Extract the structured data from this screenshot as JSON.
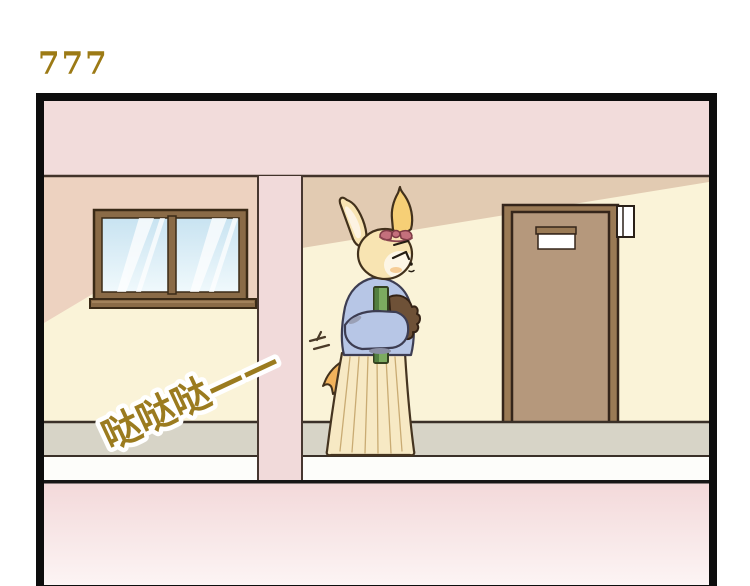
{
  "page": {
    "title": "777",
    "title_color": "#9c7a15",
    "background": "#ffffff"
  },
  "sfx": {
    "text": "哒哒哒——",
    "color": "#9b7b1f",
    "outline_color": "#ffffff"
  },
  "panel": {
    "border_color": "#0d0d0d",
    "ceiling_color": "#f2dcdb",
    "wall_color": "#faf3d8",
    "left_wall_shade_color": "#edd2c0",
    "right_wall_shade_color": "#e2cbb2",
    "pillar_color": "#f1dada",
    "floor_gray_color": "#d7d4c7",
    "floor_white_color": "#fdfdfa",
    "floor_line_color": "#161616",
    "bottom_fade_top": "#f3d9da",
    "bottom_fade_bottom": "#fcf4f4"
  },
  "window": {
    "frame_color": "#8a6b47",
    "glass_top_color": "#c8e3f1",
    "glass_bottom_color": "#f0f9fc"
  },
  "door": {
    "jamb_color": "#9a7a55",
    "panel_color": "#b5987c",
    "plate_color": "#ffffff",
    "side_sign_color": "#ffffff"
  },
  "character": {
    "fur_color": "#f8e4b2",
    "sweater_color": "#b7c6e6",
    "skirt_color": "#f7e9c4",
    "book_color": "#7cab60",
    "bag_color": "#6e5137",
    "ribbon_color": "#c4707c",
    "tail_color": "#f2b35c"
  }
}
